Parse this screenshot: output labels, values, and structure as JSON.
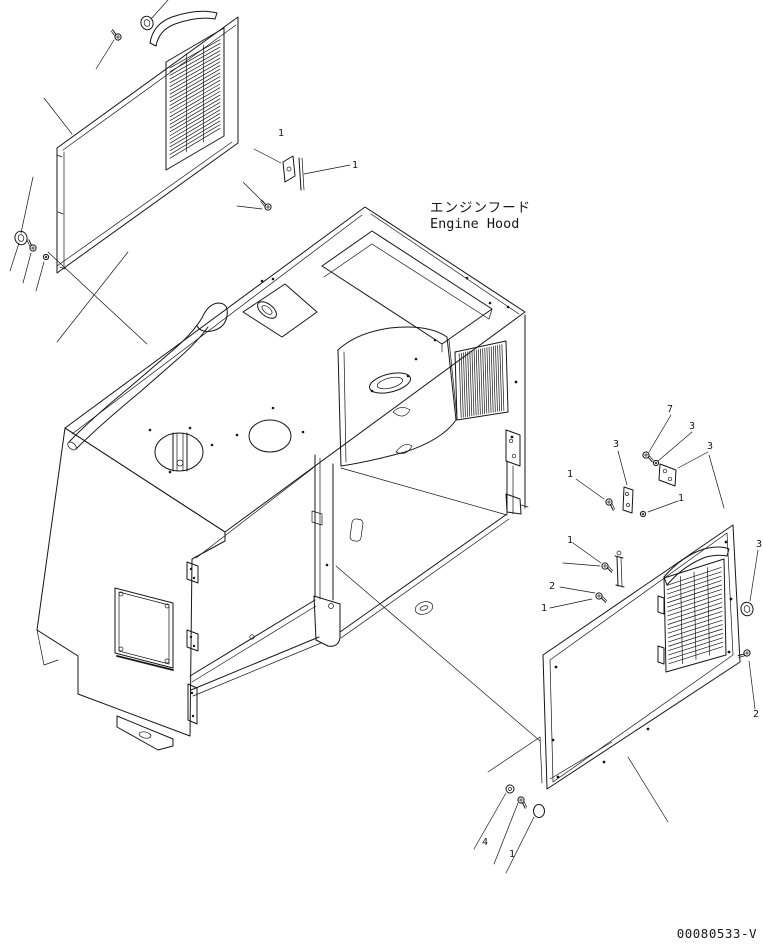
{
  "diagram": {
    "title_jp": "エンジンフード",
    "title_en": "Engine Hood",
    "drawing_number": "00080533-V"
  },
  "colors": {
    "line": "#161616",
    "background": "#ffffff"
  },
  "callouts": [
    {
      "label": "1",
      "x": 281,
      "y": 136
    },
    {
      "label": "1",
      "x": 355,
      "y": 168
    },
    {
      "label": "7",
      "x": 670,
      "y": 412
    },
    {
      "label": "3",
      "x": 692,
      "y": 429
    },
    {
      "label": "3",
      "x": 710,
      "y": 449
    },
    {
      "label": "3",
      "x": 616,
      "y": 447
    },
    {
      "label": "1",
      "x": 570,
      "y": 477
    },
    {
      "label": "1",
      "x": 681,
      "y": 501
    },
    {
      "label": "1",
      "x": 570,
      "y": 543
    },
    {
      "label": "2",
      "x": 552,
      "y": 589
    },
    {
      "label": "1",
      "x": 544,
      "y": 611
    },
    {
      "label": "3",
      "x": 759,
      "y": 547
    },
    {
      "label": "2",
      "x": 756,
      "y": 717
    },
    {
      "label": "4",
      "x": 485,
      "y": 845
    },
    {
      "label": "1",
      "x": 512,
      "y": 857
    }
  ]
}
